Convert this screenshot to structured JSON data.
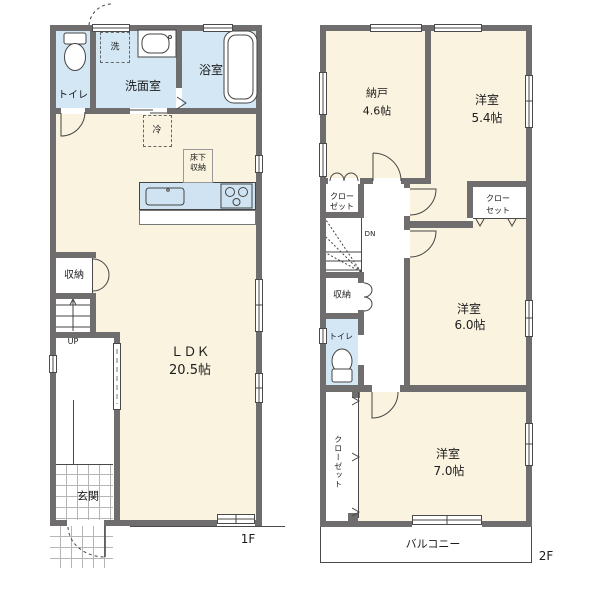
{
  "colors": {
    "wall": "#6f6d6e",
    "cream": "#faf3e0",
    "blue": "#d3e7f4",
    "counter": "#cfe3f2",
    "line": "#4a4a4a",
    "grid": "#b5b5b5",
    "text": "#1c1c1c"
  },
  "floor1": {
    "floor_label": "1F",
    "toilet": "トイレ",
    "washroom": "洗面室",
    "bathroom": "浴室",
    "washer": "洗",
    "fridge": "冷",
    "underfloor_line1": "床下",
    "underfloor_line2": "収納",
    "ldk_name": "ＬＤＫ",
    "ldk_size": "20.5帖",
    "storage": "収納",
    "stairs_up": "UP",
    "entrance": "玄関"
  },
  "floor2": {
    "floor_label": "2F",
    "nando_name": "納戸",
    "nando_size": "4.6帖",
    "bedroom_a_name": "洋室",
    "bedroom_a_size": "5.4帖",
    "bedroom_b_name": "洋室",
    "bedroom_b_size": "6.0帖",
    "bedroom_c_name": "洋室",
    "bedroom_c_size": "7.0帖",
    "closet_left_line1": "クロー",
    "closet_left_line2": "ゼット",
    "closet_right_line1": "クロー",
    "closet_right_line2": "セット",
    "closet_vertical": "クローゼット",
    "storage": "収納",
    "toilet": "トイレ",
    "stairs_down": "DN",
    "balcony": "バルコニー"
  }
}
